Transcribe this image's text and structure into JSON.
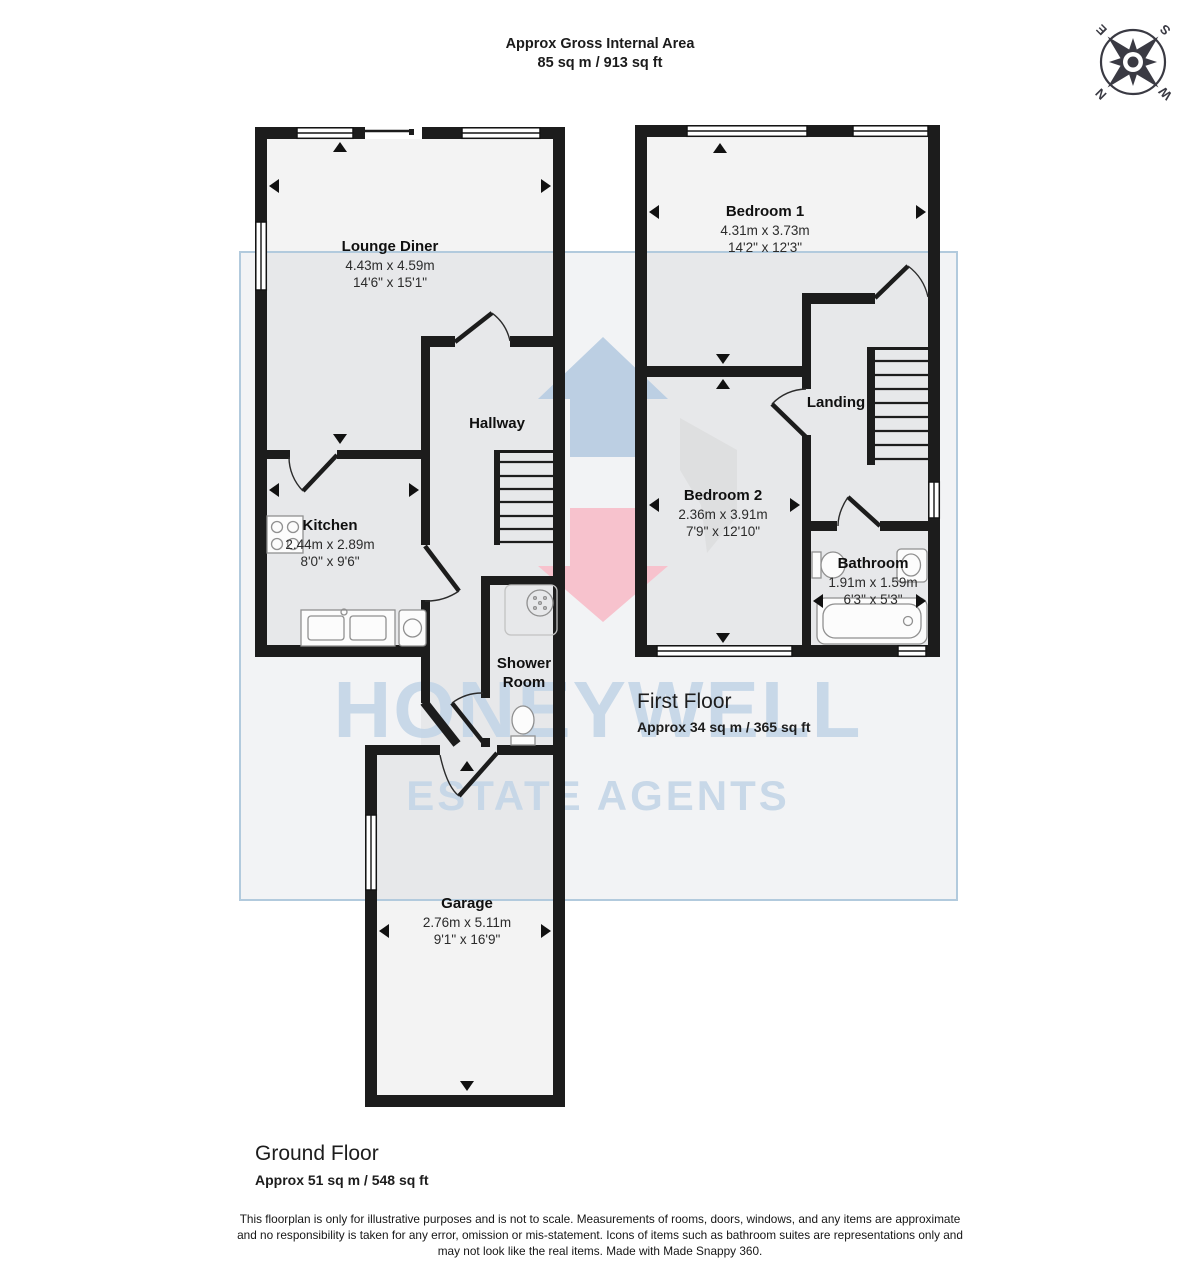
{
  "header": {
    "title": "Approx Gross Internal Area",
    "area": "85 sq m / 913 sq ft"
  },
  "compass": {
    "n": "N",
    "e": "E",
    "s": "S",
    "w": "W"
  },
  "watermark": {
    "line1": "HONEYWELL",
    "line2": "ESTATE AGENTS",
    "colors": {
      "text": "#c4d6e7",
      "panel_border": "#b2cadd",
      "arrow_blue": "#bccfe3",
      "arrow_pink": "#f7c2cd",
      "arrow_gray": "#d9d9d9"
    }
  },
  "floors": {
    "first": {
      "title": "First Floor",
      "area": "Approx 34 sq m / 365 sq ft"
    },
    "ground": {
      "title": "Ground Floor",
      "area": "Approx 51 sq m / 548 sq ft"
    }
  },
  "rooms": {
    "lounge": {
      "name": "Lounge Diner",
      "metric": "4.43m x 4.59m",
      "imperial": "14'6\" x 15'1\""
    },
    "kitchen": {
      "name": "Kitchen",
      "metric": "2.44m x 2.89m",
      "imperial": "8'0\" x 9'6\""
    },
    "hallway": {
      "name": "Hallway"
    },
    "shower": {
      "name": "Shower Room"
    },
    "garage": {
      "name": "Garage",
      "metric": "2.76m x 5.11m",
      "imperial": "9'1\" x 16'9\""
    },
    "bedroom1": {
      "name": "Bedroom 1",
      "metric": "4.31m x 3.73m",
      "imperial": "14'2\" x 12'3\""
    },
    "bedroom2": {
      "name": "Bedroom 2",
      "metric": "2.36m x 3.91m",
      "imperial": "7'9\" x 12'10\""
    },
    "landing": {
      "name": "Landing"
    },
    "bathroom": {
      "name": "Bathroom",
      "metric": "1.91m x 1.59m",
      "imperial": "6'3\" x 5'3\""
    }
  },
  "disclaimer": {
    "lines": [
      "This floorplan is only for illustrative purposes and is not to scale. Measurements of rooms, doors, windows, and any items are approximate",
      "and no responsibility is taken for any error, omission or mis-statement. Icons of items such as bathroom suites are representations only and",
      "may not look like the real items. Made with Made Snappy 360."
    ]
  }
}
